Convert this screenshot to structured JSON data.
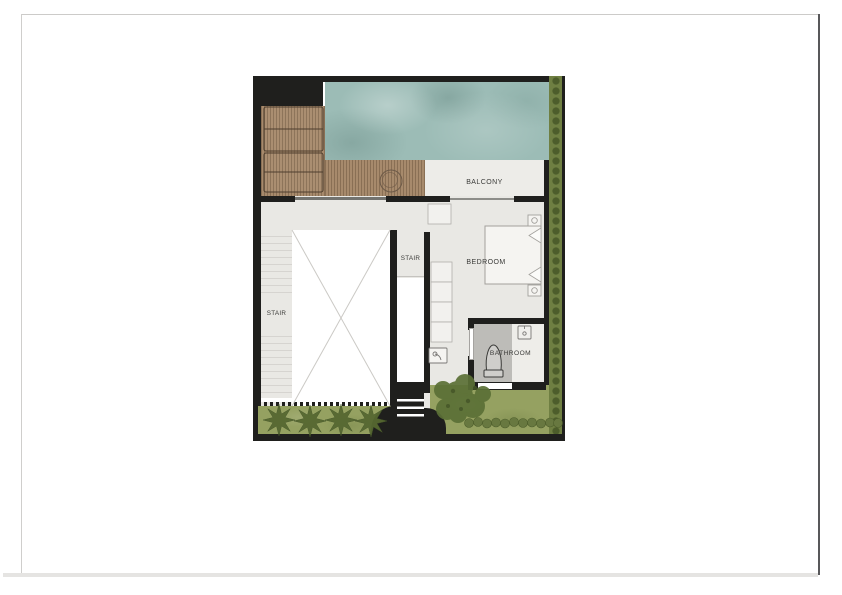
{
  "page": {
    "background": "#ffffff",
    "border_light": "#cccbc9",
    "border_dark": "#58585a",
    "bottom_band": "#e5e4e2"
  },
  "floor_plan": {
    "rooms": {
      "balcony": {
        "label": "BALCONY"
      },
      "bedroom": {
        "label": "BEDROOM"
      },
      "bathroom": {
        "label": "BATHROOM"
      },
      "stair_left": {
        "label": "STAIR"
      },
      "stair_center": {
        "label": "STAIR"
      }
    },
    "features": [
      "swimming-pool",
      "wood-deck",
      "sun-loungers",
      "planter-pot",
      "void-with-cross",
      "wardrobe",
      "bed",
      "nightstands",
      "toilet",
      "wash-basins",
      "shower",
      "entry-steps",
      "garden-shrubs",
      "tree",
      "hedge"
    ],
    "colors": {
      "wall": "#1f1f1d",
      "pool": "#9cbcb6",
      "deck": "#a78a6c",
      "hedge": "#6f7f42",
      "lawn": "#95a161",
      "tree_foliage": "#5b7036",
      "plant": "#566831",
      "floor": "#e9e8e4",
      "balcony_floor": "#edece8",
      "shower_tile": "#bdbcb8",
      "label_text": "#3b3b39"
    }
  }
}
